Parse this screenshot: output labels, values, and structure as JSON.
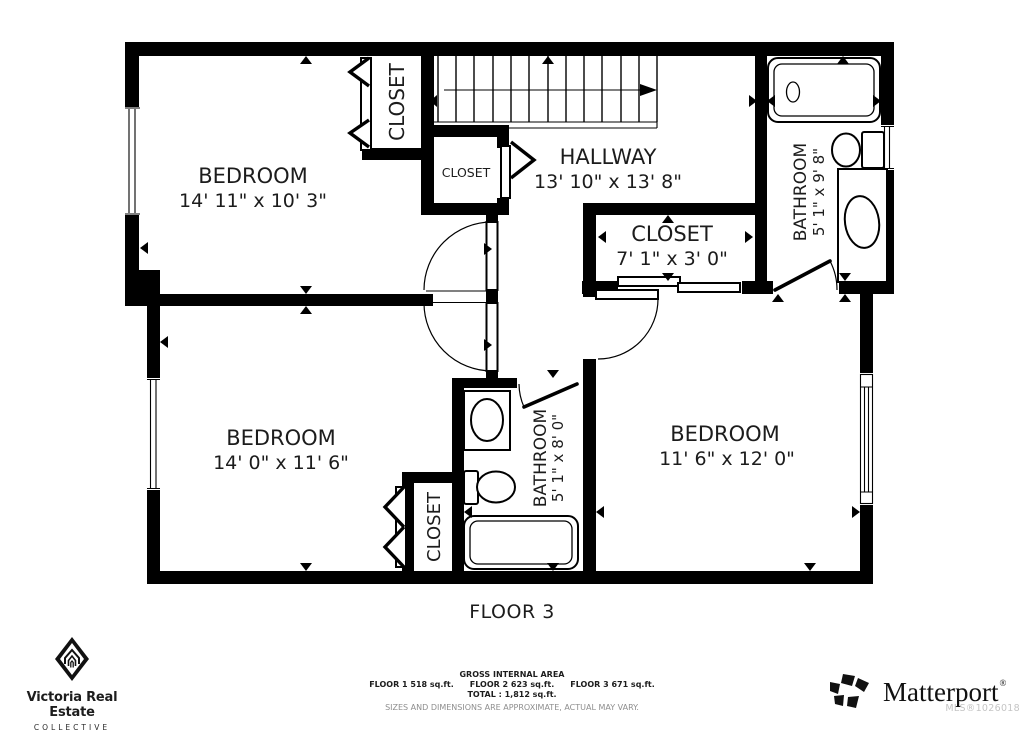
{
  "page": {
    "background": "#ffffff",
    "wall_color": "#000000",
    "text_color": "#1c1c1c",
    "muted_color": "#8e8e8e",
    "watermark_color": "#c5c5c5"
  },
  "floor": {
    "label": "FLOOR 3"
  },
  "rooms": {
    "bedroom1": {
      "name": "BEDROOM",
      "dims": "14' 11\" x 10' 3\""
    },
    "bedroom2": {
      "name": "BEDROOM",
      "dims": "14' 0\" x 11' 6\""
    },
    "bedroom3": {
      "name": "BEDROOM",
      "dims": "11' 6\" x 12' 0\""
    },
    "hallway": {
      "name": "HALLWAY",
      "dims": "13' 10\" x 13' 8\""
    },
    "closet_hall": {
      "name": "CLOSET",
      "dims": "7' 1\" x 3' 0\""
    },
    "bathroom_ensuite": {
      "name": "BATHROOM",
      "dims": "5' 1\" x 9' 8\""
    },
    "bathroom_main": {
      "name": "BATHROOM",
      "dims": "5' 1\" x 8' 0\""
    },
    "closet_top": {
      "name": "CLOSET"
    },
    "closet_landing": {
      "name": "CLOSET"
    },
    "closet_bedroom2": {
      "name": "CLOSET"
    }
  },
  "footer": {
    "area_title": "GROSS INTERNAL AREA",
    "floor1_area": "FLOOR 1 518 sq.ft.",
    "floor2_area": "FLOOR 2 623 sq.ft.",
    "floor3_area": "FLOOR 3 671 sq.ft.",
    "total_line": "TOTAL : 1,812 sq.ft.",
    "disclaimer": "SIZES AND DIMENSIONS ARE APPROXIMATE, ACTUAL MAY VARY.",
    "mls": "MLS®1026018"
  },
  "branding": {
    "agency_name": "Victoria Real Estate",
    "agency_subtitle": "COLLECTIVE",
    "provider": "Matterport",
    "provider_mark": "®"
  }
}
